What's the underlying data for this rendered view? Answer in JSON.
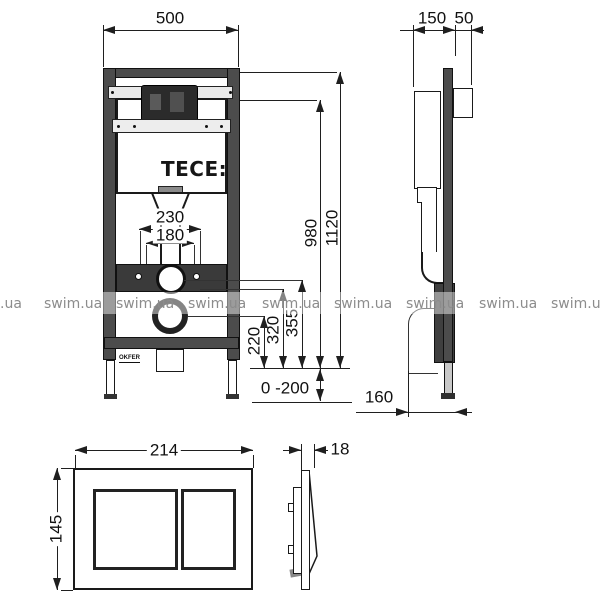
{
  "brand": {
    "logo_text": "TECE:"
  },
  "watermark": {
    "text": "swim.ua",
    "left_partial": ".ua",
    "color": "#8c8c8c"
  },
  "frame_front_view": {
    "width_mm": "500",
    "total_height_mm": "1120",
    "upper_height_mm": "980",
    "fixing_spacing_outer_mm": "230",
    "fixing_spacing_inner_mm": "180",
    "drain_center_height_mm": "220",
    "supply_height_mm": "320",
    "flush_pipe_height_mm": "355",
    "leg_adjustment_mm": "0 -200",
    "cert_mark": "OKFER"
  },
  "frame_side_view": {
    "depth_mm": "150",
    "front_offset_mm": "50",
    "base_depth_mm": "160"
  },
  "flush_plate_front_view": {
    "width_mm": "214",
    "height_mm": "145"
  },
  "flush_plate_side_view": {
    "thickness_mm": "18"
  }
}
